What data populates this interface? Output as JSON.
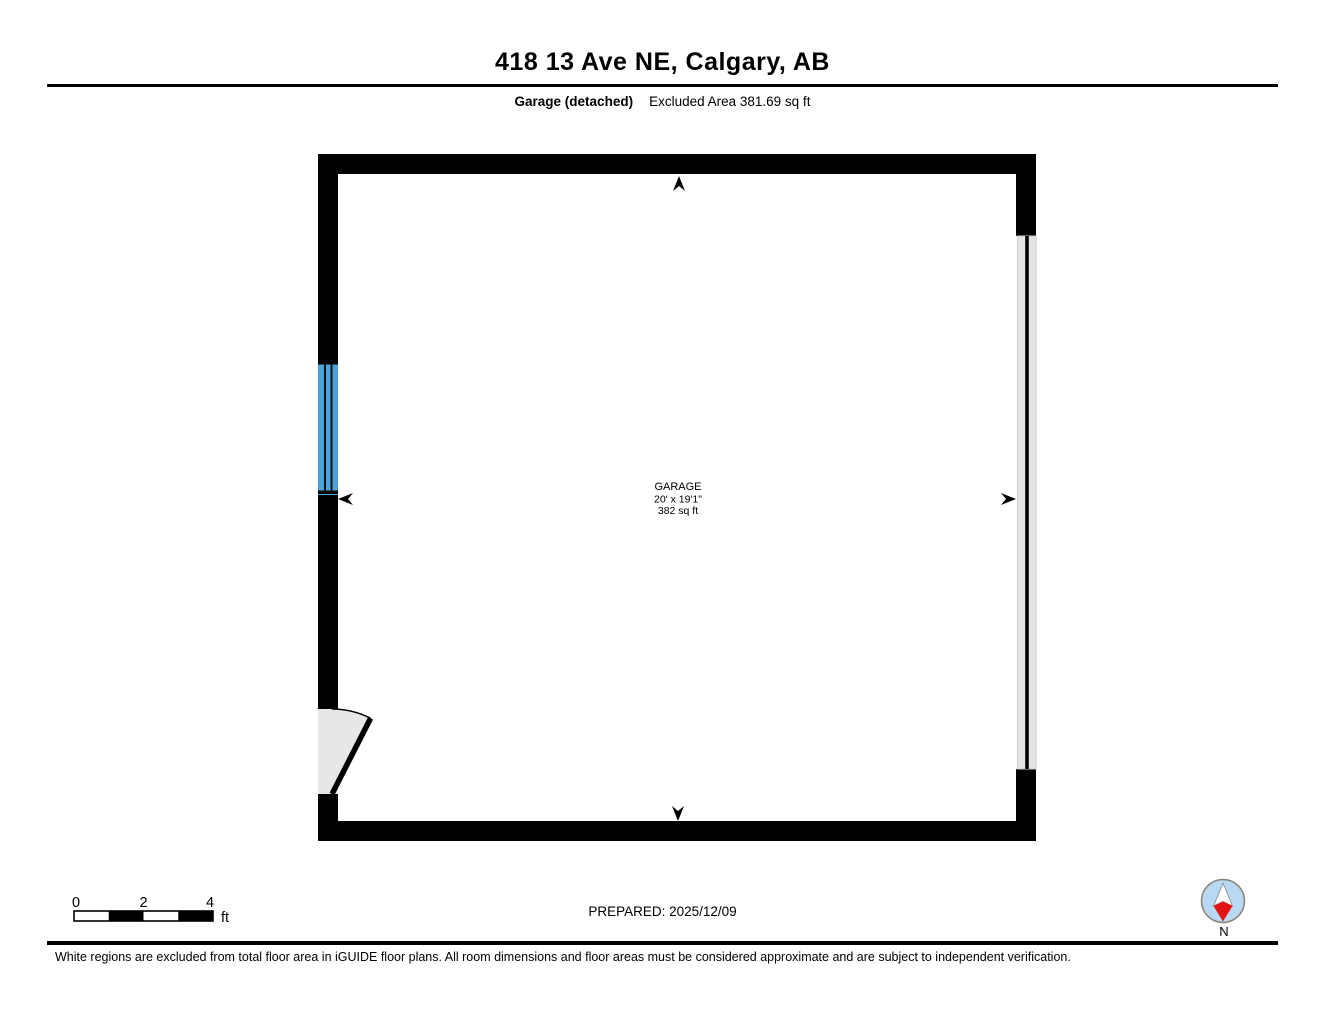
{
  "header": {
    "title": "418 13 Ave NE, Calgary, AB",
    "floor_label": "Garage (detached)",
    "excluded_area_label": "Excluded Area 381.69 sq ft"
  },
  "plan": {
    "room_label": {
      "name": "GARAGE",
      "dimensions": "20' x 19'1\"",
      "area": "382 sq ft"
    },
    "colors": {
      "wall": "#000000",
      "window": "#4aa3d8",
      "garage_door": "#e4e4e4",
      "door_swing": "#e7e7e7"
    }
  },
  "scale_bar": {
    "ticks": [
      "0",
      "2",
      "4"
    ],
    "unit": "ft"
  },
  "prepared_label": "PREPARED: 2025/12/09",
  "compass": {
    "north_label": "N",
    "circle_fill": "#b7d9f3",
    "needle_south": "#e31414",
    "needle_north": "#ffffff"
  },
  "footer": {
    "disclaimer": "White regions are excluded from total floor area in iGUIDE floor plans. All room dimensions and floor areas must be considered approximate and are subject to independent verification."
  }
}
